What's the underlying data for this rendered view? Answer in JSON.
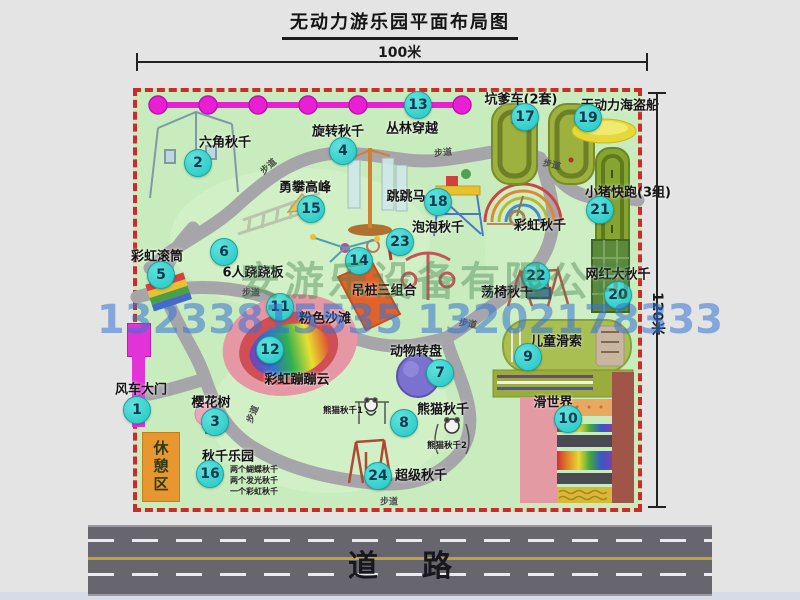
{
  "title": "无动力游乐园平面布局图",
  "dims": {
    "width": "100米",
    "height": "120米"
  },
  "watermark": {
    "company": "安游乐设备有限公司",
    "phone": "13233815535 13202178333"
  },
  "road_label": "道路",
  "rest_area": "休憩区",
  "footpath": "步道",
  "extra_labels": {
    "rainbow_swing": "彩虹秋千",
    "panda_swing_1": "熊猫秋千1",
    "panda_swing_2": "熊猫秋千2"
  },
  "items": [
    {
      "num": "1",
      "label": "风车大门"
    },
    {
      "num": "2",
      "label": "六角秋千"
    },
    {
      "num": "3",
      "label": "樱花树"
    },
    {
      "num": "4",
      "label": "旋转秋千"
    },
    {
      "num": "5",
      "label": "彩虹滚筒"
    },
    {
      "num": "6",
      "label": "6人跷跷板"
    },
    {
      "num": "7",
      "label": "动物转盘"
    },
    {
      "num": "8",
      "label": "熊猫秋千"
    },
    {
      "num": "9",
      "label": "儿童滑索"
    },
    {
      "num": "10",
      "label": "滑世界"
    },
    {
      "num": "11",
      "label": "粉色沙滩"
    },
    {
      "num": "12",
      "label": "彩虹蹦蹦云"
    },
    {
      "num": "13",
      "label": "丛林穿越"
    },
    {
      "num": "14",
      "label": "吊桩三组合"
    },
    {
      "num": "15",
      "label": "勇攀高峰"
    },
    {
      "num": "16",
      "label": "秋千乐园",
      "notes": [
        "两个蝴蝶秋千",
        "两个发光秋千",
        "一个彩虹秋千"
      ]
    },
    {
      "num": "17",
      "label": "坑爹车(2套)"
    },
    {
      "num": "18",
      "label": "跳跳马"
    },
    {
      "num": "19",
      "label": "无动力海盗船"
    },
    {
      "num": "20",
      "label": "网红大秋千"
    },
    {
      "num": "21",
      "label": "小猪快跑(3组)"
    },
    {
      "num": "22",
      "label": "荡椅秋千"
    },
    {
      "num": "23",
      "label": "泡泡秋千"
    },
    {
      "num": "24",
      "label": "超级秋千"
    }
  ],
  "colors": {
    "map_green": "#c9ecbf",
    "border_red": "#cf2a2a",
    "badge_cyan": "#22c6c3",
    "gate_magenta": "#e233d6",
    "road_gray": "#67666f",
    "path_gray": "#a6a6aa"
  }
}
